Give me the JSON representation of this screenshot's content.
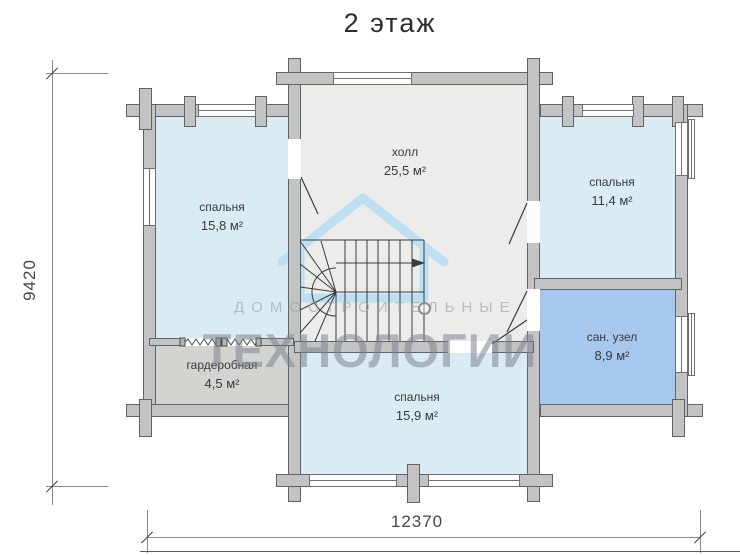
{
  "title": "2 этаж",
  "rooms": [
    {
      "id": "bedroom-left",
      "name": "спальня",
      "area": "15,8 м²"
    },
    {
      "id": "hall",
      "name": "холл",
      "area": "25,5 м²"
    },
    {
      "id": "bedroom-right",
      "name": "спальня",
      "area": "11,4 м²"
    },
    {
      "id": "bathroom",
      "name": "сан. узел",
      "area": "8,9 м²"
    },
    {
      "id": "wardrobe",
      "name": "гардеробная",
      "area": "4,5 м²"
    },
    {
      "id": "bedroom-bottom",
      "name": "спальня",
      "area": "15,9 м²"
    }
  ],
  "dimensions": {
    "vertical": "9420",
    "horizontal": "12370"
  },
  "watermark": {
    "line1": "ДОМОСТРОИТЕЛЬНЫЕ",
    "line2": "ТЕХНОЛОГИИ"
  },
  "colors": {
    "wall": "#c3c3c3",
    "room_light_blue": "#d9ecf4",
    "bathroom_blue": "#a6c8ee",
    "hall_gray": "#ececea",
    "wardrobe_gray": "#d3d3cf",
    "watermark_blue": "#bcdff2"
  }
}
